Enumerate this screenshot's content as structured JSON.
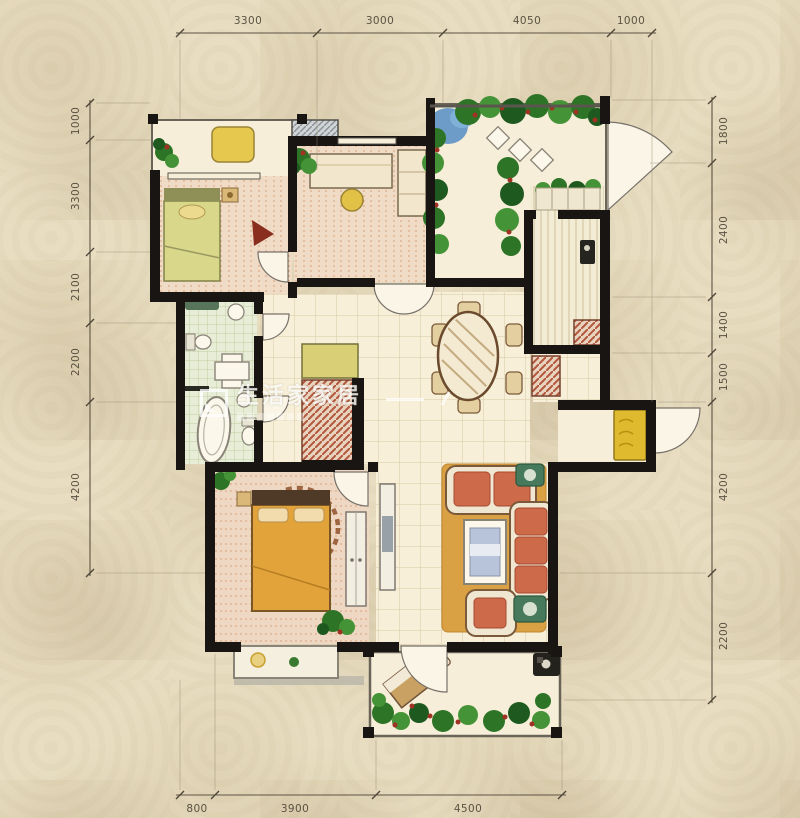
{
  "watermark": {
    "brand": "生活家家居"
  },
  "dimensions": {
    "top": [
      "3300",
      "3000",
      "4050",
      "1000"
    ],
    "left": [
      "1000",
      "3300",
      "2100",
      "2200",
      "4200"
    ],
    "right": [
      "1800",
      "2400",
      "1400",
      "1500",
      "4200",
      "2200"
    ],
    "bottom": [
      "800",
      "3900",
      "4500"
    ]
  },
  "colors": {
    "wall": "#181512",
    "background": "#e8ddc1",
    "floor": "#f7efd8",
    "plant_green": "#2e7427",
    "cabinet_red": "#b2563c",
    "dim_text": "#4c4437"
  }
}
